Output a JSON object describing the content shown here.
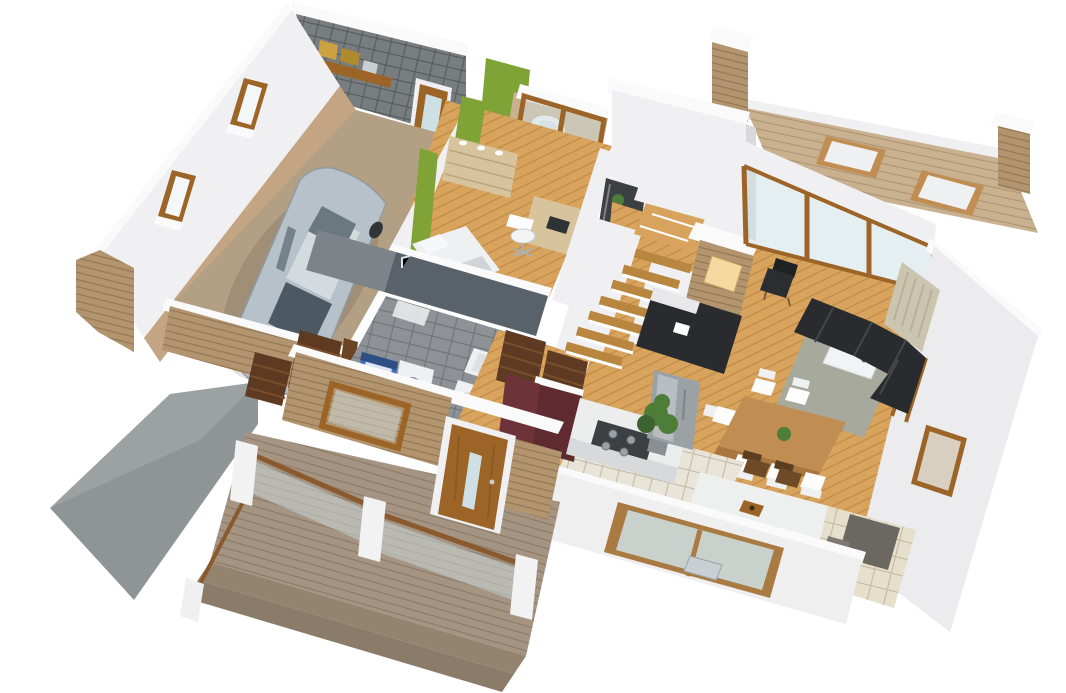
{
  "scene": {
    "kind": "3d-floor-plan-cutaway-render",
    "view": "isometric",
    "rooms": [
      {
        "id": "garage",
        "items": [
          "car",
          "tiled-wall-shelf",
          "windows",
          "slatted-gate"
        ]
      },
      {
        "id": "bedroom-office",
        "items": [
          "bed",
          "dresser",
          "desk",
          "office-chair",
          "display-case"
        ]
      },
      {
        "id": "bathroom",
        "items": [
          "freestanding-tub",
          "bidet",
          "glass-doors"
        ]
      },
      {
        "id": "utility-bathroom",
        "items": [
          "boiler",
          "washing-machine",
          "sink",
          "toilet",
          "bathtub",
          "shower"
        ]
      },
      {
        "id": "hallway",
        "items": [
          "slatted-double-doors",
          "interior-door"
        ]
      },
      {
        "id": "staircase",
        "items": [
          "winder-stairs"
        ]
      },
      {
        "id": "living-room",
        "items": [
          "sectional-sofa",
          "coffee-table",
          "rug",
          "armchair",
          "fireplace",
          "tv-bench",
          "curtain",
          "ladder-shelf",
          "terrace-glass-wall"
        ]
      },
      {
        "id": "dining-area",
        "items": [
          "dining-table",
          "six-chairs",
          "plant-centerpiece"
        ]
      },
      {
        "id": "kitchen",
        "items": [
          "maroon-cabinets",
          "cooktop",
          "fridge",
          "plant",
          "island-bar",
          "bar-stools",
          "sink-window"
        ]
      },
      {
        "id": "pantry",
        "items": [
          "wardrobe",
          "tile-floor"
        ]
      },
      {
        "id": "terrace",
        "items": [
          "deck",
          "loungers",
          "stone-pillars"
        ]
      },
      {
        "id": "porch",
        "items": [
          "deck",
          "steps",
          "glass-railings",
          "front-door",
          "stone-walls"
        ]
      },
      {
        "id": "driveway",
        "items": []
      }
    ]
  },
  "palette": {
    "background": "#ffffff",
    "wallWhite": "#f0f0f2",
    "wallBright": "#fafafb",
    "wallShade": "#d9d9dc",
    "darkWall": "#59626a",
    "woodFloor": "#d8a35c",
    "woodFloorDark": "#b9863f",
    "terraceWood": "#c9b190",
    "porchWood": "#a59482",
    "stepWood": "#93836f",
    "stone": "#b2946f",
    "stoneDark": "#8f7352",
    "tileGray": "#787d80",
    "slateFloor": "#8e9296",
    "greenWall": "#7fa336",
    "carBody": "#b6c1c9",
    "carGlass": "#4d5962",
    "boilerBlue": "#3f6fbe",
    "applianceWhite": "#eef0f1",
    "cabinetMaroon": "#5f2b31",
    "sofaBlack": "#292b2e",
    "furnitureWood": "#c08e52",
    "doorWood": "#9c6527",
    "doorWoodDark": "#5e3a22",
    "rugGreen": "#a6a99b",
    "curtain": "#cbc4ae",
    "kitchenTile": "#e8e4d8",
    "driveway": "#8f9496",
    "fridgeGray": "#9ba1a5",
    "plantGreen": "#4e7d3a",
    "glass": "#cfe0e4",
    "warmLight": "#f5d9a0",
    "concrete": "#b3a084",
    "beigeWood": "#d8c49c",
    "pantryFloor": "#e6dfcc",
    "wardrobeGray": "#6b6861",
    "islandDark": "#3b3e41",
    "cooktop": "#3c4043"
  }
}
